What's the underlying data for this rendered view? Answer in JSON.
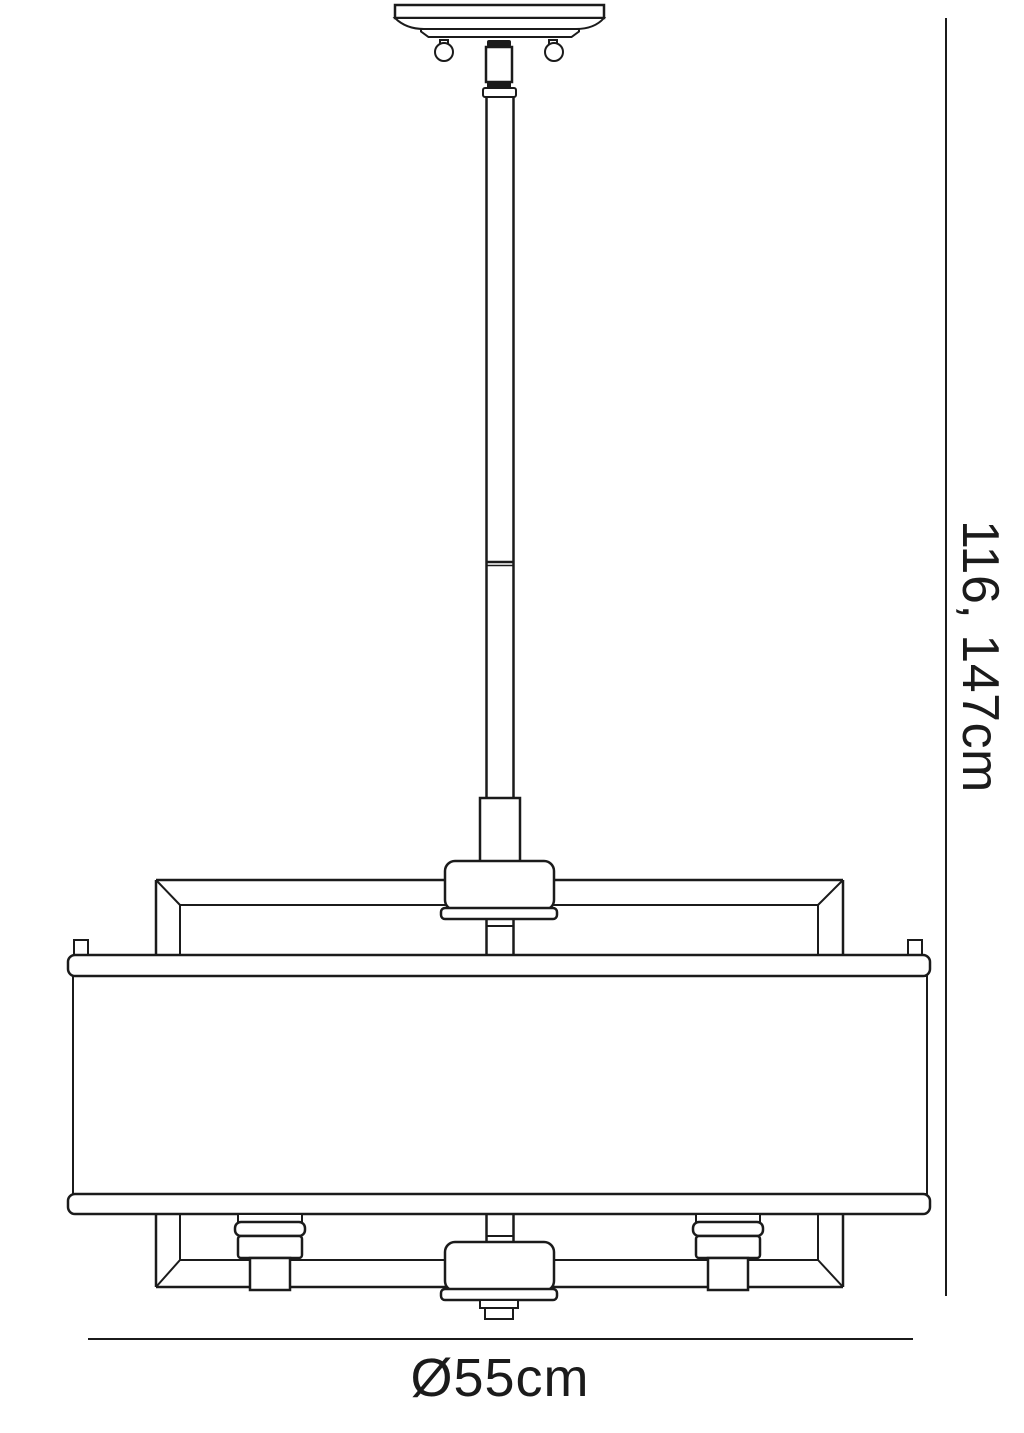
{
  "colors": {
    "ink": "#1b1b1b",
    "background": "#ffffff"
  },
  "dimensions": {
    "height_label": "116, 147cm",
    "diameter_label": "Ø55cm"
  }
}
